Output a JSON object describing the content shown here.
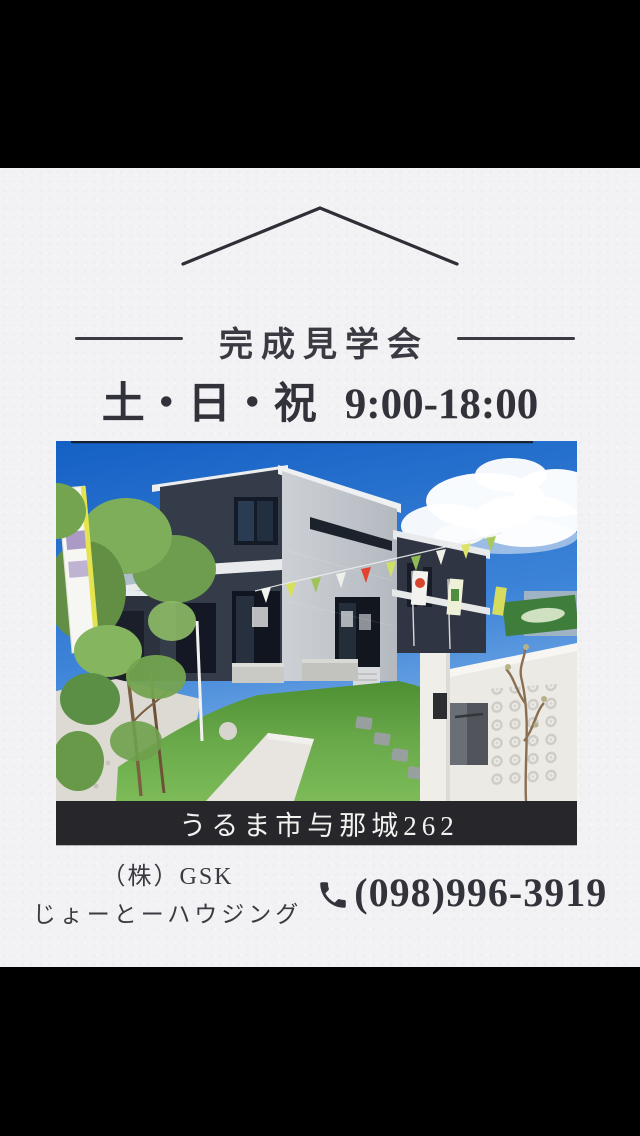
{
  "flyer": {
    "colors": {
      "letterbox": "#000000",
      "paper": "#f2f1f3",
      "ink": "#3a3a42",
      "address_bar_bg": "#26262b",
      "address_bar_text": "#f3f2f0"
    },
    "header": {
      "title": "完成見学会",
      "days": "土・日・祝",
      "time": "9:00-18:00"
    },
    "photo": {
      "description": "新築2階建て住宅の外観写真。紺色と白い外壁、青空と白い雲、人工芝の庭、白いブロック塀と黒いポスト、左手に緑の植栽とのぼり旗、軒先にガーランド旗",
      "banner_text": "新",
      "colors": {
        "sky": "#2b72cf",
        "house_dark": "#333a47",
        "house_light": "#c7cbd1",
        "lawn": "#66a447",
        "wall": "#eceae5"
      }
    },
    "address_bar": {
      "text": "うるま市与那城262"
    },
    "footer": {
      "company_line1": "（株）GSK",
      "company_line2": "じょーとーハウジング",
      "phone_icon": "phone-receiver-icon",
      "phone": "(098)996-3919"
    }
  }
}
